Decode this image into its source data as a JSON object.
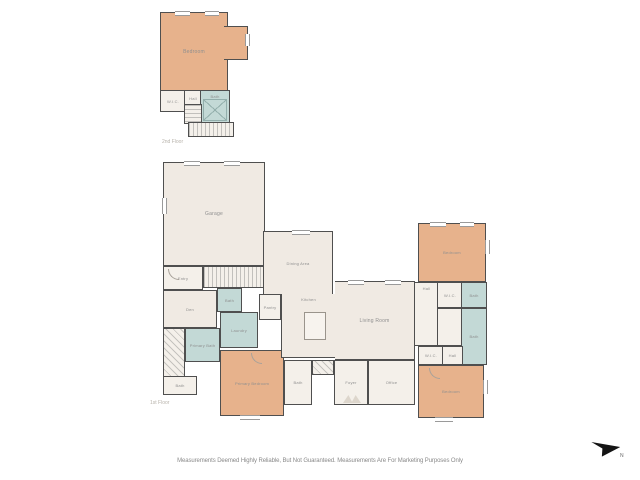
{
  "floors": {
    "upper": {
      "caption": "2nd Floor",
      "rooms": {
        "bedroom": "Bedroom",
        "wic": "W.I.C.",
        "hall": "Hall",
        "bath": "Bath"
      }
    },
    "main": {
      "caption": "1st Floor",
      "rooms": {
        "garage": "Garage",
        "entry": "Entry",
        "den": "Den",
        "bath_hall": "Bath",
        "laundry": "Laundry",
        "primary_bath": "Primary Bath",
        "powder": "Bath",
        "primary_bedroom": "Primary Bedroom",
        "pantry": "Pantry",
        "dining": "Dining Area",
        "kitchen": "Kitchen",
        "living": "Living Room",
        "bath_front": "Bath",
        "foyer": "Foyer",
        "office": "Office",
        "bedroom_ne": "Bedroom",
        "wic_ne": "W.I.C.",
        "bath_ne": "Bath",
        "hall": "Hall",
        "bath_se": "Bath",
        "wic_se": "W.I.C.",
        "hall_se": "Hall",
        "bedroom_se": "Bedroom"
      }
    }
  },
  "footer": {
    "disclaimer": "Measurements Deemed Highly Reliable, But Not Guaranteed. Measurements Are For Marketing Purposes Only"
  },
  "compass": {
    "label": "N"
  },
  "colors": {
    "wall": "#4f4f4f",
    "bedroom_fill": "#e7b28c",
    "bath_fill": "#c3d9d6",
    "room_fill": "#f0eae3",
    "room_fill_light": "#f4f0ea",
    "label_color": "#8f8f8f",
    "disclaimer_color": "#8a8a8a"
  }
}
